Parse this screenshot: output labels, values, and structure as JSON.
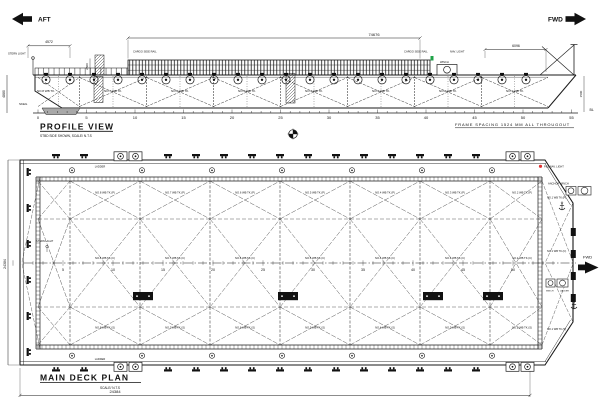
{
  "colors": {
    "line": "#1a1a1a",
    "nav_green": "#1fa348",
    "nav_red": "#e03131",
    "paper": "#ffffff"
  },
  "orientation": {
    "aft": "AFT",
    "fwd": "FWD"
  },
  "profile": {
    "title": "PROFILE VIEW",
    "subtitle": "STBD SIDE SHOWN, SCALE/ N.T.S",
    "frame_note": "FRAME SPACING 1524 MM ALL THROUGOUT",
    "dims": {
      "overall_length": "74676",
      "stern_overhang": "4572",
      "bow_overhang": "6096",
      "depth": "4880",
      "rail_height": "2500",
      "bow_rake_height": "1500",
      "baseline": "BL"
    },
    "labels": {
      "stern_light": "STERN LIGHT",
      "cargo_rail_left": "CARGO SIDE RAIL",
      "cargo_rail_right": "CARGO SIDE RAIL",
      "nav_light": "NAV. LIGHT",
      "winch": "WINCH",
      "skeg": "SKEG"
    },
    "frames": [
      "0",
      "5",
      "10",
      "15",
      "20",
      "25",
      "30",
      "35",
      "40",
      "45",
      "50",
      "55"
    ],
    "tanks": [
      "NO.8 WB TK.",
      "NO.7 WB TK.",
      "NO.6 WB TK.",
      "NO.5 WB TK.",
      "NO.4 WB TK.",
      "NO.3 WB TK.",
      "NO.2 WB TK.",
      "NO.1 WB TK."
    ]
  },
  "deck": {
    "title": "MAIN DECK PLAN",
    "subtitle": "SCALE/ N.T.S",
    "dims": {
      "length": "24384",
      "breadth": "24384"
    },
    "labels": {
      "ladder_top": "LADDER",
      "ladder_bottom": "LADDER",
      "stern_light": "STERN LIGHT",
      "nav_light": "P&S NAV. LIGHT",
      "anchor_winch": "ANCHOR WINCH",
      "winch": "WINCH",
      "ladder_bow": "LADDER",
      "fwd": "FWD"
    },
    "frames": [
      "5",
      "10",
      "15",
      "20",
      "25",
      "30",
      "35",
      "40",
      "45",
      "50"
    ],
    "tanks_port": [
      "NO.8 WB TK.(P)",
      "NO.7 WB TK.(P)",
      "NO.6 WB TK.(P)",
      "NO.5 WB TK.(P)",
      "NO.4 WB TK.(P)",
      "NO.3 WB TK.(P)",
      "NO.2 WB TK.(P)"
    ],
    "tanks_center": [
      "NO.8 WB TK.(C)",
      "NO.7 WB TK.(C)",
      "NO.6 WB TK.(C)",
      "NO.5 WB TK.(C)",
      "NO.4 WB TK.(C)",
      "NO.3 WB TK.(C)",
      "NO.2 WB TK.(C)"
    ],
    "tanks_stbd": [
      "NO.8 WB TK.(S)",
      "NO.7 WB TK.(S)",
      "NO.6 WB TK.(S)",
      "NO.5 WB TK.(S)",
      "NO.4 WB TK.(S)",
      "NO.3 WB TK.(S)",
      "NO.2 WB TK.(S)"
    ],
    "bow_tanks": [
      "NO.1 WB TK.(P)",
      "NO.1 WB TK.(C)",
      "NO.1 WB TK.(S)"
    ]
  }
}
